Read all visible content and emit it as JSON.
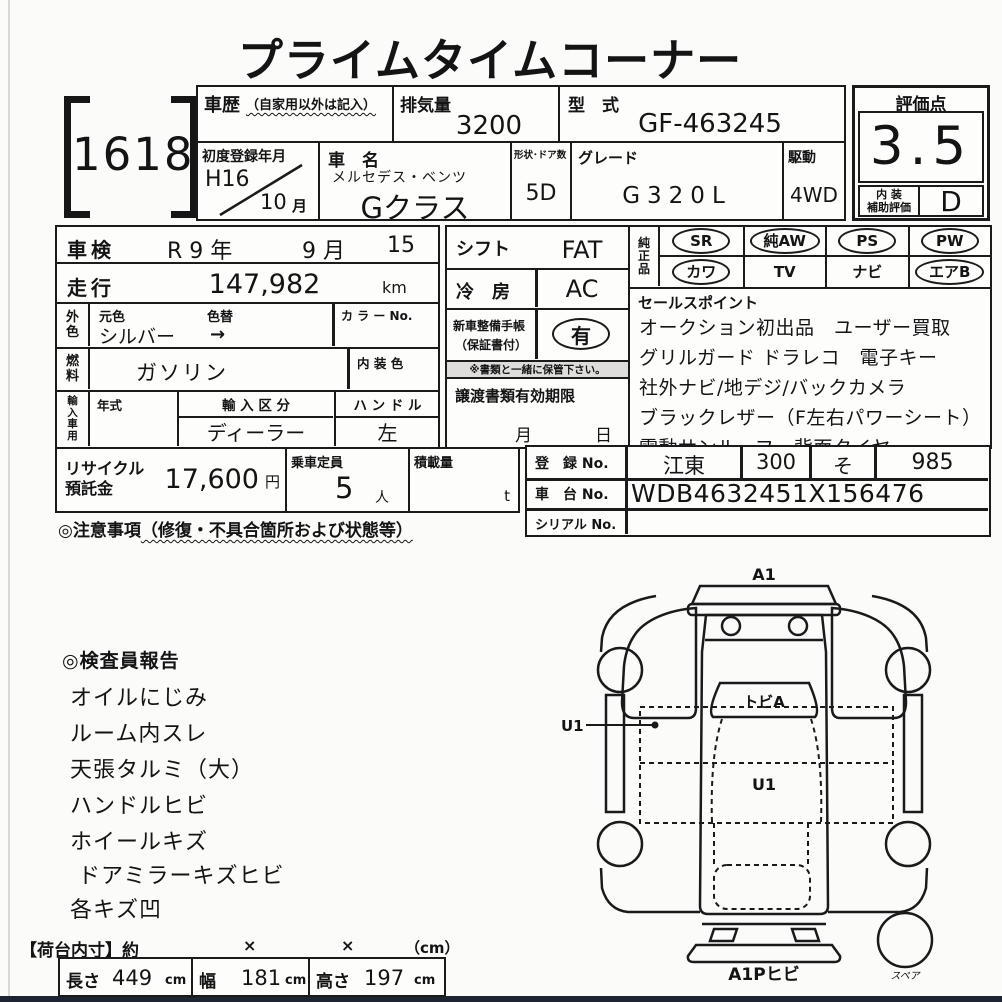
{
  "title": "プライムタイムコーナー",
  "lot": {
    "number": "16185"
  },
  "header": {
    "history": {
      "label": "車歴",
      "note": "（自家用以外は記入）",
      "value": ""
    },
    "displacement": {
      "label": "排気量",
      "value": "3200"
    },
    "model_code": {
      "label": "型　式",
      "value": "GF-463245"
    },
    "first_reg": {
      "label": "初度登録年月",
      "year": "H16",
      "month": "10",
      "month_unit": "月"
    },
    "car_name": {
      "label": "車　名",
      "maker": "メルセデス・ベンツ",
      "name": "Gクラス"
    },
    "doors": {
      "label": "形状･ドア数",
      "value": "5D"
    },
    "grade": {
      "label": "グレード",
      "value": "G320L"
    },
    "drive": {
      "label": "駆動",
      "value": "4WD"
    },
    "score": {
      "label": "評価点",
      "value": "3.5"
    },
    "interior": {
      "label": "内 装\n補助評価",
      "value": "D"
    }
  },
  "vehicle": {
    "shaken": {
      "label": "車検",
      "era_year": "R 9 年",
      "month": "9 月",
      "day": "15 日"
    },
    "mileage": {
      "label": "走行",
      "value": "147,982",
      "unit": "km"
    },
    "color": {
      "side_label": "外\n色",
      "orig_label": "元色",
      "change_label": "色替",
      "value": "シルバー",
      "arrow": "→",
      "color_no_label": "カ ラ ー No."
    },
    "fuel": {
      "side_label": "燃\n料",
      "value": "ガソリン",
      "interior_color_label": "内 装 色"
    },
    "import": {
      "side_label": "輸\n入\n車\n用",
      "year_label": "年式",
      "division_label": "輸 入 区 分",
      "division_value": "ディーラー",
      "handle_label": "ハ ン ド ル",
      "handle_value": "左"
    }
  },
  "equipment": {
    "shift": {
      "label": "シフト",
      "value": "FAT"
    },
    "aircon": {
      "label": "冷　房",
      "value": "AC"
    },
    "record_book": {
      "label_line1": "新車整備手帳",
      "label_line2": "（保証書付）",
      "value": "有"
    },
    "note": "※書類と一緒に保管下さい。",
    "transfer_docs": {
      "label": "譲渡書類有効期限",
      "month_unit": "月",
      "day_unit": "日"
    }
  },
  "genuine_parts": {
    "label": "純\n正\n品",
    "items": [
      {
        "label": "SR",
        "circled": true
      },
      {
        "label": "純AW",
        "circled": true
      },
      {
        "label": "PS",
        "circled": true
      },
      {
        "label": "PW",
        "circled": true
      },
      {
        "label": "カワ",
        "circled": true
      },
      {
        "label": "TV",
        "circled": false
      },
      {
        "label": "ナビ",
        "circled": false
      },
      {
        "label": "エアB",
        "circled": true
      }
    ]
  },
  "sales_points": {
    "label": "セールスポイント",
    "lines": [
      "オークション初出品　ユーザー買取",
      "グリルガード ドラレコ　電子キー",
      "社外ナビ/地デジ/バックカメラ",
      "ブラックレザー（F左右パワーシート）",
      "電動サンルーフ　背面タイヤ"
    ]
  },
  "recycle": {
    "label_line1": "リサイクル",
    "label_line2": "預託金",
    "value": "17,600",
    "unit": "円"
  },
  "capacity": {
    "label": "乗車定員",
    "value": "5",
    "unit": "人"
  },
  "load": {
    "label": "積載量",
    "unit": "t"
  },
  "caution": {
    "prefix": "◎注意事項",
    "paren": "（修復・不具合箇所および状態等）"
  },
  "registration": {
    "reg_no": {
      "label": "登　録 No.",
      "area": "江東",
      "class_no": "300",
      "kana": "そ",
      "number": "985"
    },
    "chassis_no": {
      "label": "車　台 No.",
      "value": "WDB4632451X156476"
    },
    "serial_no": {
      "label": "シリアル No.",
      "value": ""
    }
  },
  "inspector_report": {
    "title": "◎検査員報告",
    "items": [
      "オイルにじみ",
      "ルーム内スレ",
      "天張タルミ（大）",
      "ハンドルヒビ",
      "ホイールキズ",
      "ドアミラーキズヒビ",
      "各キズ凹"
    ]
  },
  "dimensions": {
    "header_label": "【荷台内寸】約",
    "x1": "×",
    "x2": "×",
    "unit_note": "（cm）",
    "length": {
      "label": "長さ",
      "value": "449",
      "unit": "cm"
    },
    "width": {
      "label": "幅",
      "value": "181",
      "unit": "cm"
    },
    "height": {
      "label": "高さ",
      "value": "197",
      "unit": "cm"
    }
  },
  "diagram": {
    "label_top": "A1",
    "label_windshield": "トビA",
    "label_u1_callout": "U1",
    "label_u1_center": "U1",
    "label_bottom": "A1Pヒビ",
    "label_spare": "スペア"
  }
}
